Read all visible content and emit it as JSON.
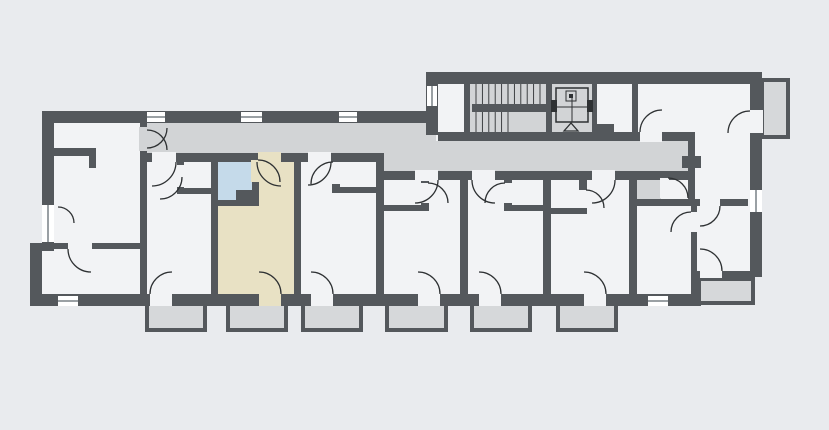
{
  "scene": {
    "type": "architectural-floor-plan",
    "description": "apartment-building-floor-plan-with-highlighted-unit",
    "units_visible": 8,
    "bottom_balconies": 6,
    "side_balconies": 2,
    "has_stairwell": true,
    "has_elevator": true,
    "highlighted_unit": {
      "position": "second-from-left-lower-row",
      "has_highlighted_bathroom": true
    }
  },
  "palette": {
    "background": "#e9ebee",
    "room": "#f2f3f5",
    "corridor": "#d2d4d6",
    "balcony": "#d6d8da",
    "unit_highlight": "#e8e1c4",
    "bath_highlight": "#c5daea",
    "wall": "#54585c",
    "line": "#2e3133",
    "window_fill": "#ffffff",
    "window_line": "#9aa0a4"
  }
}
